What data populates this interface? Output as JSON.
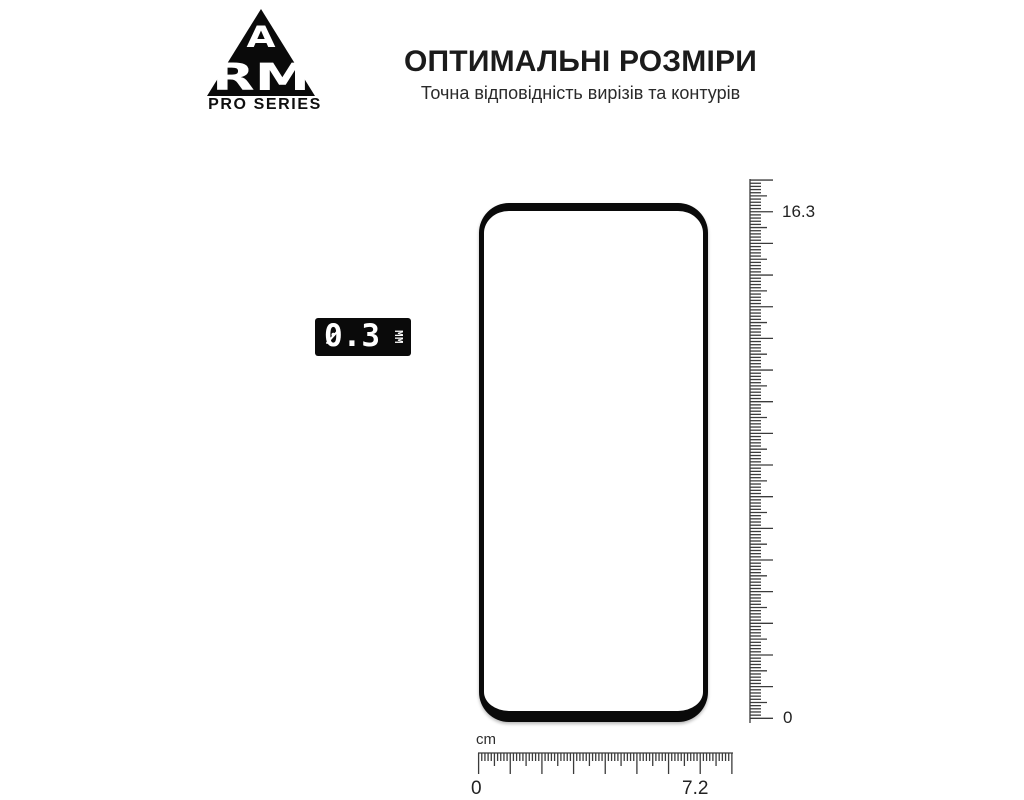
{
  "brand": {
    "letter_a": "A",
    "letters_rm": "RM",
    "series_label": "PRO SERIES"
  },
  "heading": {
    "title": "ОПТИМАЛЬНІ РОЗМІРИ",
    "subtitle": "Точна відповідність вирізів та контурів"
  },
  "thickness_badge": {
    "value": "0.3",
    "unit": "ММ"
  },
  "glass": {
    "width_cm": 7.2,
    "height_cm": 16.3,
    "thickness_mm": 0.3
  },
  "vertical_ruler": {
    "top_label": "16.3",
    "bottom_label": "0"
  },
  "horizontal_ruler": {
    "unit_label": "cm",
    "left_label": "0",
    "right_label": "7.2"
  },
  "colors": {
    "ink": "#0a0a0a",
    "tick": "#3b3b3b",
    "title": "#1b1b1b",
    "background": "#ffffff"
  }
}
